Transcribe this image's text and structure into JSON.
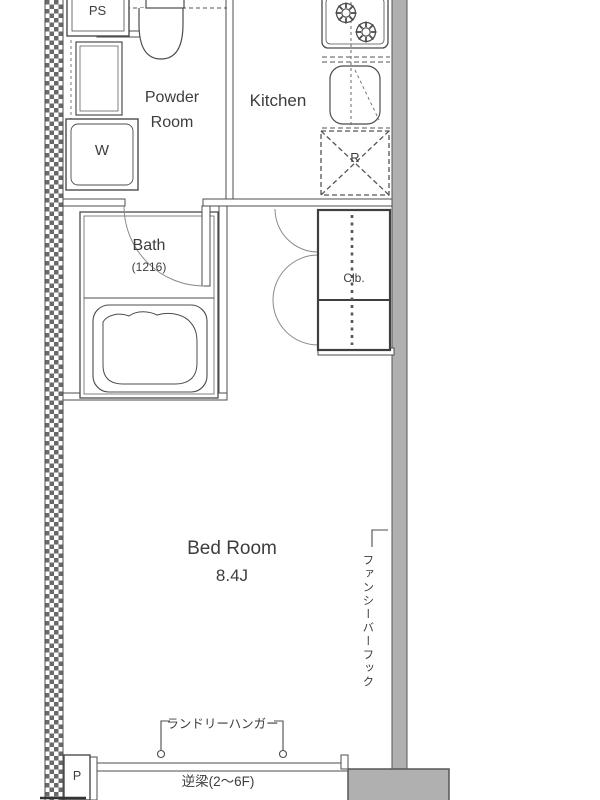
{
  "plan": {
    "labels": {
      "ps": "PS",
      "powder_room_1": "Powder",
      "powder_room_2": "Room",
      "kitchen": "Kitchen",
      "washer": "W",
      "bath": "Bath",
      "bath_size": "(1216)",
      "refrigerator": "R",
      "closet": "Clb.",
      "bedroom": "Bed Room",
      "bedroom_size": "8.4J",
      "laundry_hanger": "ランドリーハンガー",
      "fancy_bar_hook": "ファンシーバーフック",
      "reverse_beam": "逆梁(2〜6F)",
      "pillar": "P"
    },
    "colors": {
      "wall_gray": "#b1b0b0",
      "line_dark": "#4c4c4c"
    }
  }
}
